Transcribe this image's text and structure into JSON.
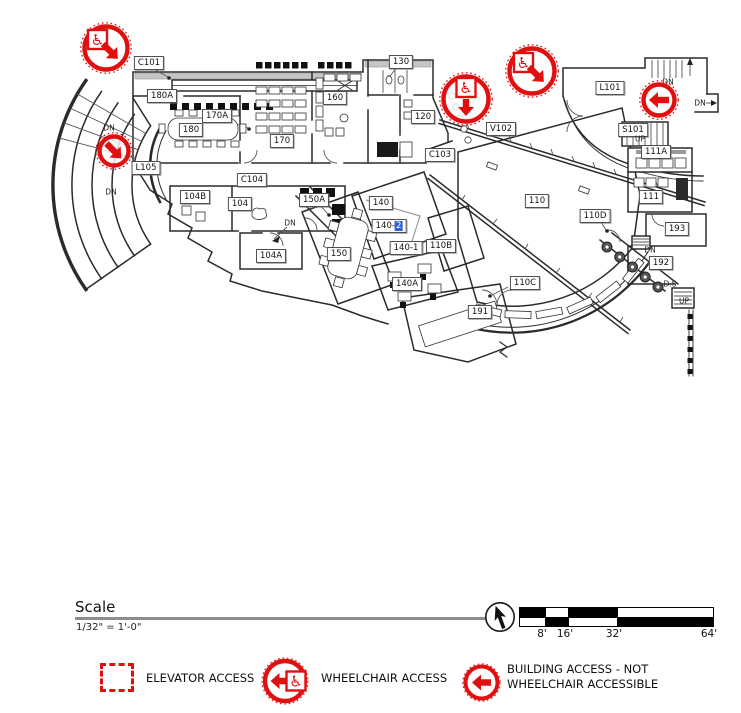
{
  "colors": {
    "accent_red": "#e01010",
    "highlight_blue": "#2e5fd3",
    "wall": "#2b2b2b"
  },
  "icons": {
    "wheelchair_glyph": "♿"
  },
  "plan": {
    "rooms": [
      {
        "id": "C101",
        "x": 149,
        "y": 63
      },
      {
        "id": "180A",
        "x": 162,
        "y": 96
      },
      {
        "id": "170A",
        "x": 217,
        "y": 116
      },
      {
        "id": "180",
        "x": 191,
        "y": 130
      },
      {
        "id": "170",
        "x": 282,
        "y": 141
      },
      {
        "id": "160",
        "x": 335,
        "y": 98
      },
      {
        "id": "130",
        "x": 401,
        "y": 62
      },
      {
        "id": "120",
        "x": 423,
        "y": 117
      },
      {
        "id": "V102",
        "x": 501,
        "y": 129
      },
      {
        "id": "C103",
        "x": 440,
        "y": 155
      },
      {
        "id": "L101",
        "x": 610,
        "y": 88
      },
      {
        "id": "S101",
        "x": 633,
        "y": 130
      },
      {
        "id": "111A",
        "x": 656,
        "y": 152
      },
      {
        "id": "111",
        "x": 651,
        "y": 197
      },
      {
        "id": "L105",
        "x": 146,
        "y": 168
      },
      {
        "id": "C104",
        "x": 252,
        "y": 180
      },
      {
        "id": "104B",
        "x": 195,
        "y": 197
      },
      {
        "id": "104",
        "x": 240,
        "y": 204
      },
      {
        "id": "150A",
        "x": 314,
        "y": 200
      },
      {
        "id": "140",
        "x": 381,
        "y": 203
      },
      {
        "id": "140-2",
        "x": 389,
        "y": 226,
        "prefix": "140-",
        "highlight_suffix": "2"
      },
      {
        "id": "140-1",
        "x": 406,
        "y": 248
      },
      {
        "id": "104A",
        "x": 271,
        "y": 256
      },
      {
        "id": "150",
        "x": 339,
        "y": 254
      },
      {
        "id": "140A",
        "x": 407,
        "y": 284
      },
      {
        "id": "110B",
        "x": 441,
        "y": 246
      },
      {
        "id": "110",
        "x": 537,
        "y": 201
      },
      {
        "id": "110D",
        "x": 595,
        "y": 216
      },
      {
        "id": "110C",
        "x": 525,
        "y": 283
      },
      {
        "id": "191",
        "x": 480,
        "y": 312
      },
      {
        "id": "193",
        "x": 677,
        "y": 229
      },
      {
        "id": "192",
        "x": 661,
        "y": 263
      }
    ],
    "stair_labels": [
      {
        "text": "DN",
        "x": 109,
        "y": 128
      },
      {
        "text": "DN",
        "x": 111,
        "y": 192
      },
      {
        "text": "DN",
        "x": 290,
        "y": 223
      },
      {
        "text": "DN",
        "x": 668,
        "y": 82
      },
      {
        "text": "DN",
        "x": 700,
        "y": 103
      },
      {
        "text": "UP",
        "x": 640,
        "y": 139
      },
      {
        "text": "DN",
        "x": 650,
        "y": 250
      },
      {
        "text": "D.S",
        "x": 670,
        "y": 284
      },
      {
        "text": "UP",
        "x": 684,
        "y": 301
      }
    ],
    "markers": [
      {
        "type": "wheelchair",
        "dir": "down-right",
        "x": 106,
        "y": 48,
        "r": 23
      },
      {
        "type": "arrow",
        "dir": "down-right",
        "x": 114,
        "y": 151,
        "r": 16
      },
      {
        "type": "wheelchair",
        "dir": "down",
        "x": 466,
        "y": 99,
        "r": 24
      },
      {
        "type": "wheelchair",
        "dir": "down-right",
        "x": 532,
        "y": 71,
        "r": 24
      },
      {
        "type": "arrow",
        "dir": "left",
        "x": 659,
        "y": 100,
        "r": 17
      }
    ]
  },
  "scale": {
    "title": "Scale",
    "ratio": "1/32\" = 1'-0\"",
    "ticks": [
      "8'",
      "16'",
      "32'",
      "64'"
    ]
  },
  "legend": {
    "items": [
      {
        "icon": "elevator",
        "label": "ELEVATOR ACCESS"
      },
      {
        "icon": "wheelchair",
        "label": "WHEELCHAIR ACCESS"
      },
      {
        "icon": "arrow",
        "label": "BUILDING ACCESS - NOT WHEELCHAIR ACCESSIBLE"
      }
    ]
  }
}
